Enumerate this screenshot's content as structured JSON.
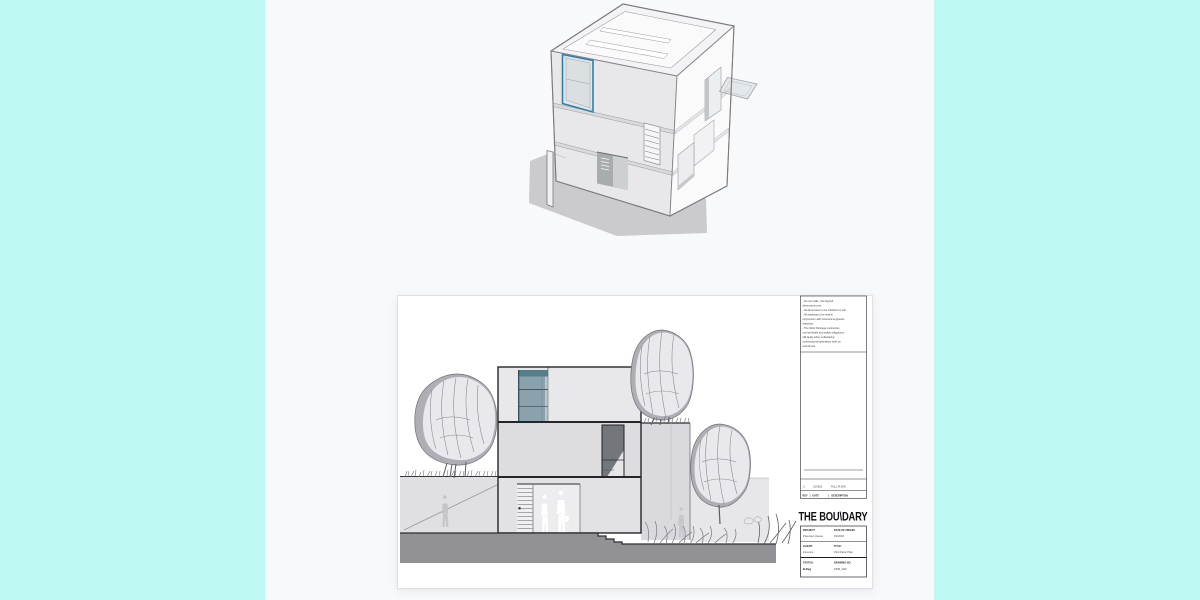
{
  "colors": {
    "background": "#bdf8f2",
    "panel": "#f8f9fa",
    "sheet": "#ffffff",
    "accent_window_blue": "#2e80ac",
    "drawing_ink": "#26262a",
    "shadow_gray": "#cacacf"
  },
  "sheet": {
    "notes": [
      "- Do not scale. Use figured",
      "dimensions only.",
      "- All dimensions to be checked on site.",
      "- All drawings to be read in",
      "conjunction with structural engineers",
      "drawings.",
      "- The Work Package contractors",
      "normal health and safety obligations",
      "still apply when undertaking",
      "constructional operations both on",
      "and off site."
    ],
    "revision": {
      "rev": "0",
      "date": "01/2018",
      "description": "FULL PLANS",
      "header_rev": "REV",
      "header_date": "DATE",
      "header_description": "DESCRIPTION",
      "separator": "|"
    },
    "logo": "THE BOU\\DARY",
    "fields": {
      "project_label": "PROJECT:",
      "project_value": "Petersen House",
      "origin_label": "DATE OF ORIGIN:",
      "origin_value": "01/2018",
      "client_label": "CLIENT:",
      "client_value": "Ference",
      "title_label": "TITLE:",
      "title_value": "First Floor Plan",
      "status_label": "STATUS:",
      "status_value": "B.Reg",
      "drawing_label": "DRAWING NO",
      "drawing_value": "1806_090"
    }
  }
}
